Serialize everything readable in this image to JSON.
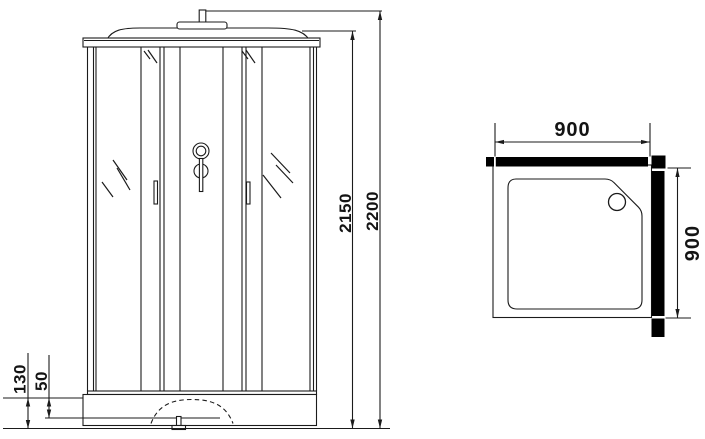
{
  "colors": {
    "line": "#1b1b1b",
    "wall_fill": "#000000",
    "background": "#ffffff",
    "label_text": "#141414"
  },
  "front_view": {
    "dims": {
      "height_to_roof": "2150",
      "height_total": "2200",
      "base_height": "130",
      "base_step": "50"
    }
  },
  "plan_view": {
    "dims": {
      "width_top": "900",
      "depth_right": "900"
    }
  }
}
